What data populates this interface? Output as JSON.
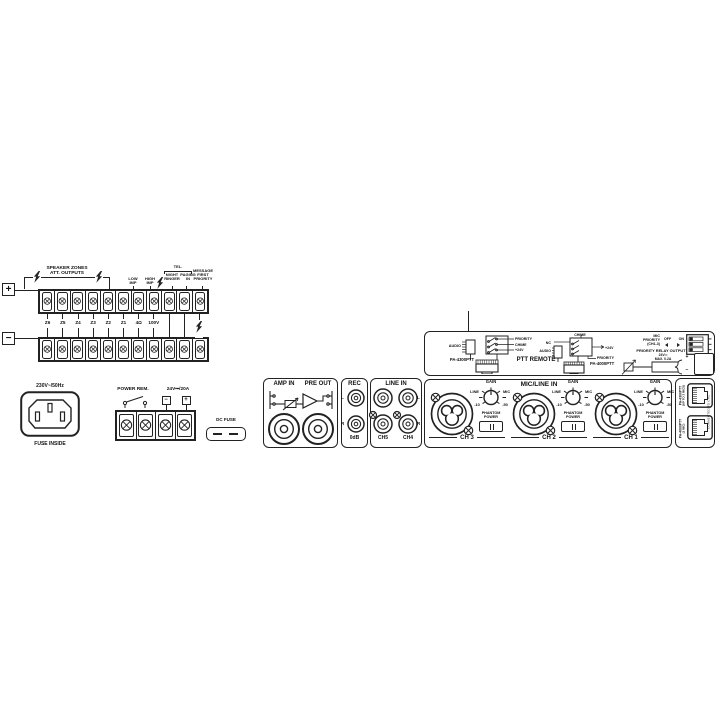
{
  "speaker_terminals": {
    "plus": "+",
    "minus": "−",
    "bracket_label": "SPEAKER ZONES\nATT. OUTPUTS",
    "tel_label": "TEL.",
    "top_labels": [
      "LOW\nIMP",
      "HIGH\nIMP",
      "NIGHT\nRINGER",
      "PAGING\nIN",
      "MESSAGE\nFIRST\nPRIORITY"
    ],
    "zone_labels": [
      "Z6",
      "Z5",
      "Z4",
      "Z3",
      "Z2",
      "Z1",
      "4Ω",
      "100V"
    ],
    "terminal_count": 11
  },
  "power": {
    "mains_label": "230V~/50Hz",
    "fuse_label": "FUSE INSIDE",
    "power_rem_label": "POWER REM.",
    "dc_label": "24V⎓/20A",
    "minus": "−",
    "plus": "+",
    "dc_fuse_label": "DC FUSE",
    "terminal_count": 4
  },
  "panels": {
    "amp_in": "AMP IN",
    "pre_out": "PRE OUT",
    "rec": {
      "title": "REC",
      "l": "L",
      "r": "R",
      "db": "0dB"
    },
    "line_in": {
      "title": "LINE IN",
      "l": "L",
      "r": "R",
      "ch5": "CH5",
      "ch4": "CH4"
    },
    "mic_line_in": {
      "title": "MIC/LINE IN",
      "gain": "GAIN",
      "line": "LINE",
      "mic": "MIC",
      "min": "-10",
      "max": "-50",
      "phantom": "PHANTOM\nPOWER",
      "channels": [
        {
          "label": "CH 3"
        },
        {
          "label": "CH 2"
        },
        {
          "label": "CH 1"
        }
      ]
    },
    "ptt": {
      "title": "PTT REMOTE",
      "left_model": "PA-4300PTT",
      "right_model": "PA-4000PTT",
      "audio": "AUDIO",
      "nc": "NC",
      "chime": "CHIME",
      "priority": "PRIORITY",
      "v24": "+24V",
      "mic_priority": "MIC\nPRIORITY\n(CH1-3)",
      "off": "OFF",
      "on": "ON",
      "relay_title": "PRIORITY RELAY OUTPUT",
      "relay_spec": "24V⎓\nMAX. 0.2A",
      "relay_plus": "+",
      "relay_minus": "−"
    },
    "rj45": {
      "top_label": "PA-4300PTT",
      "top_sub": "(UP TO 3 MICS)",
      "bottom_label": "PA-4000PTT",
      "bottom_sub": "(1 MIC)",
      "side_label": "CONNECTED TO CH1"
    }
  }
}
